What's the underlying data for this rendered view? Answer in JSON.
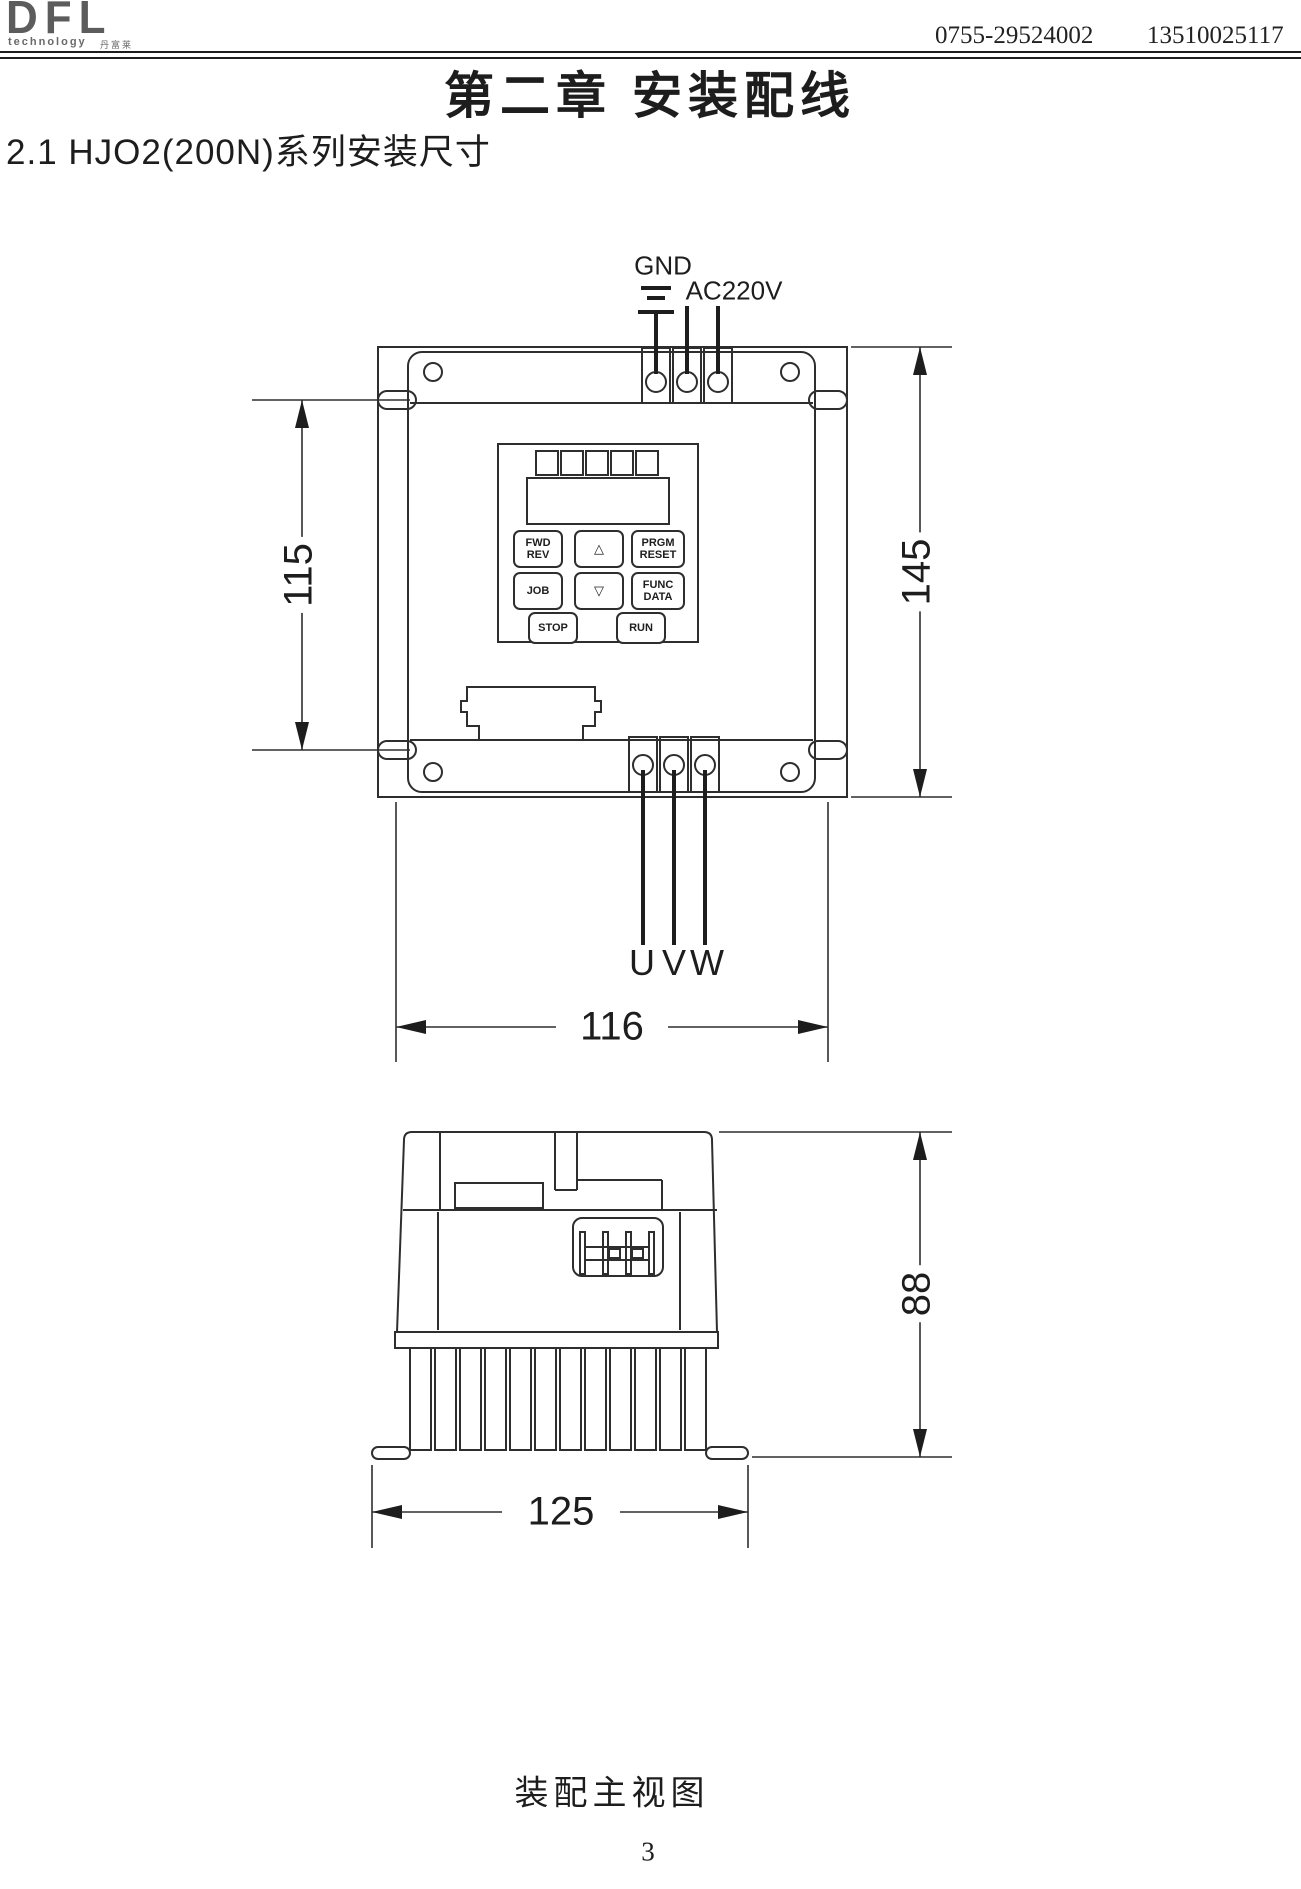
{
  "header": {
    "logo_text": "DFL",
    "logo_subtext": "technology",
    "logo_cjk": "丹富莱",
    "phone_1": "0755-29524002",
    "phone_2": "13510025117"
  },
  "title": "第二章 安装配线",
  "section_heading": "2.1 HJO2(200N)系列安装尺寸",
  "front_view": {
    "label_gnd": "GND",
    "label_ac": "AC220V",
    "dim_mount_height": "115",
    "dim_total_height": "145",
    "dim_mount_width": "116",
    "terminal_u": "U",
    "terminal_v": "V",
    "terminal_w": "W",
    "keypad": {
      "btn_fwd": "FWD",
      "btn_rev": "REV",
      "btn_up": "△",
      "btn_prgm": "PRGM",
      "btn_reset": "RESET",
      "btn_job": "JOB",
      "btn_down": "▽",
      "btn_func": "FUNC",
      "btn_data": "DATA",
      "btn_stop": "STOP",
      "btn_run": "RUN"
    }
  },
  "side_view": {
    "dim_depth": "88",
    "dim_total_width": "125"
  },
  "caption": "装配主视图",
  "page_number": "3",
  "colors": {
    "ink": "#1d1d1d",
    "line": "#2e2e2e",
    "logo_gray": "#5c5c5c"
  }
}
